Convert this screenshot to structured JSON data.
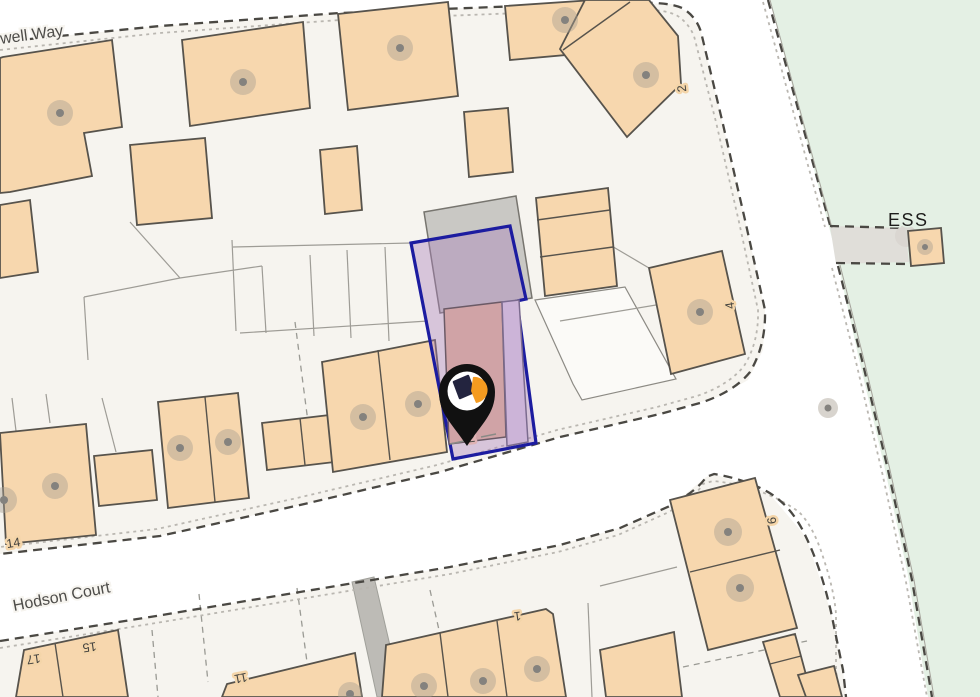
{
  "map": {
    "type": "property-location-map",
    "streets": [
      {
        "name": "owell Way"
      },
      {
        "name": "Hodson Court"
      }
    ],
    "area_labels": [
      {
        "name": "ESS"
      }
    ],
    "house_numbers": [
      {
        "text": "2"
      },
      {
        "text": "4"
      },
      {
        "text": "6"
      },
      {
        "text": "14"
      },
      {
        "text": "17"
      },
      {
        "text": "15"
      },
      {
        "text": "11"
      },
      {
        "text": "1"
      }
    ],
    "selected_property": {
      "number": "2",
      "outline_color": "#1c1ca0",
      "fill_color": "rgba(171,128,187,0.40)",
      "house_fill": "#d0a3a6"
    },
    "marker": {
      "name": "property-pin",
      "body_color": "#111111",
      "logo_colors": [
        "#23243f",
        "#f49b20"
      ]
    },
    "colors": {
      "building": "#f7d7ae",
      "building_border": "#57534c",
      "block_background": "#f6f4ef",
      "road": "#ffffff",
      "green_area": "#e4f0e4",
      "gray_building": "#c9c8c4",
      "path": "#bdbbb6",
      "edge_dash_dark": "#4a4843",
      "edge_dash_light": "#bab7b1"
    }
  }
}
